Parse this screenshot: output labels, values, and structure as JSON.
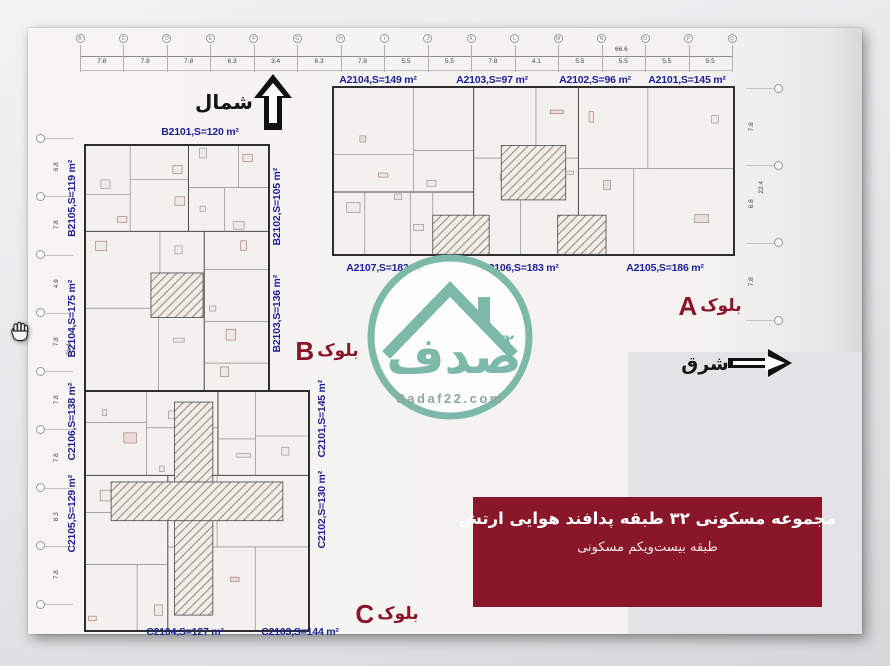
{
  "colors": {
    "dark_red": "#8a1629",
    "label_blue": "#1e1e96",
    "logo_teal": "#7cb9a8",
    "sheet": "#f4f3f2"
  },
  "compass": {
    "north_label": "شمال",
    "east_label": "شرق"
  },
  "logo": {
    "brand_text": "صدف",
    "number_fa": "۲۲",
    "site": "Sadaf22.com"
  },
  "blocks": {
    "a": {
      "label_fa": "بلوک",
      "label_letter": "A",
      "units_top": [
        "A2104,S=149 m²",
        "A2103,S=97 m²",
        "A2102,S=96 m²",
        "A2101,S=145 m²"
      ],
      "units_bottom": [
        "A2107,S=183 m²",
        "A2106,S=183 m²",
        "A2105,S=186 m²"
      ]
    },
    "b": {
      "label_fa": "بلوک",
      "label_letter": "B",
      "unit_top": "B2101,S=120 m²",
      "units_left": [
        "B2105,S=119 m²",
        "B2104,S=175 m²"
      ],
      "units_right": [
        "B2102,S=105 m²",
        "B2103,S=136 m²"
      ]
    },
    "c": {
      "label_fa": "بلوک",
      "label_letter": "C",
      "units_left": [
        "C2106,S=138 m²",
        "C2105,S=129 m²"
      ],
      "units_right": [
        "C2101,S=145 m²",
        "C2102,S=130 m²"
      ],
      "units_bottom": [
        "C2104,S=127 m²",
        "C2103,S=144 m²"
      ]
    }
  },
  "rulers": {
    "top": {
      "segments": [
        "7.8",
        "7.8",
        "7.8",
        "6.3",
        "3.4",
        "6.3",
        "7.8",
        "5.5",
        "5.5",
        "7.8",
        "4.1",
        "5.5",
        "5.5",
        "5.5",
        "5.5"
      ],
      "total": "66.6",
      "grid_letters": [
        "B",
        "C",
        "D",
        "E",
        "F",
        "G",
        "H",
        "I",
        "J",
        "K",
        "L",
        "M",
        "N",
        "O",
        "P",
        "Q"
      ]
    },
    "left": {
      "segments": [
        "6.8",
        "7.8",
        "4.9",
        "7.8",
        "7.8",
        "7.8",
        "8.3",
        "7.8"
      ],
      "total": "71.1",
      "grid_letters": []
    },
    "right": {
      "segments": [
        "7.8",
        "6.8",
        "7.8"
      ],
      "total": "22.4",
      "grid_letters": []
    }
  },
  "banner": {
    "line1": "مجموعه مسکونی ۳۲ طبقه پدافند هوایی ارتش",
    "line2": "طبقه بیست‌ویکم مسکونی",
    "bg": "#8a1629"
  }
}
